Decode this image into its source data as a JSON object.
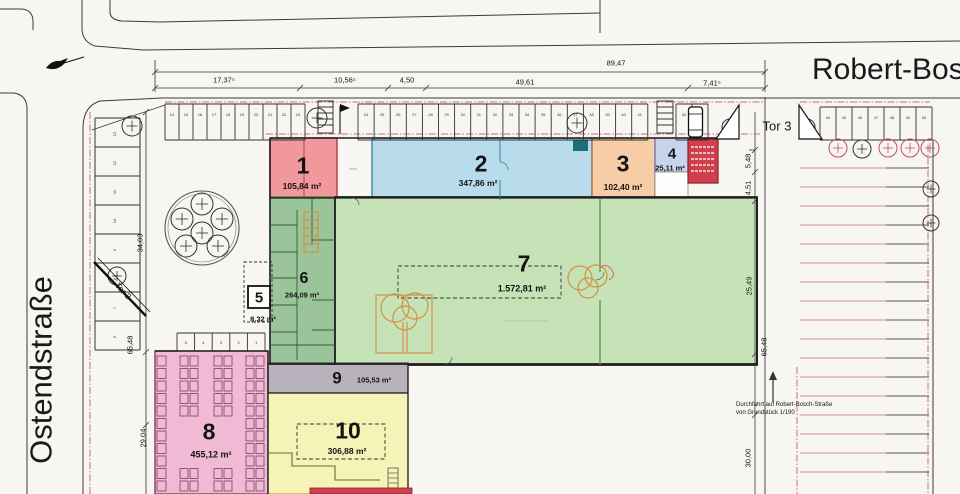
{
  "streets": {
    "top": "Robert-Bosch-Straße",
    "left": "Ostendstraße"
  },
  "gates": {
    "tor3": "Tor 3",
    "tor2": "Tor 2"
  },
  "areas": [
    {
      "num": "1",
      "size": "105,84 m²"
    },
    {
      "num": "2",
      "size": "347,86 m²"
    },
    {
      "num": "3",
      "size": "102,40 m²"
    },
    {
      "num": "4",
      "size": "25,11 m²"
    },
    {
      "num": "5",
      "size": "8,32 m²"
    },
    {
      "num": "6",
      "size": "264,09 m²"
    },
    {
      "num": "7",
      "size": "1.572,81 m²"
    },
    {
      "num": "8",
      "size": "455,12 m²"
    },
    {
      "num": "9",
      "size": "105,53 m²"
    },
    {
      "num": "10",
      "size": "306,88 m²"
    }
  ],
  "dimensions": {
    "total_top": "89,47",
    "top": [
      "17,37⁵",
      "10,56⁵",
      "4,50",
      "49,61",
      "7,41⁵"
    ],
    "left": [
      "34,03",
      "65,48",
      "29,04"
    ],
    "right": [
      "5,48",
      "4,51",
      "25,49",
      "65,48",
      "30,00"
    ]
  },
  "note": {
    "line1": "Durchfahrt auf Robert-Bosch-Straße",
    "line2": "von Grundstück 1/190"
  },
  "parking": {
    "top_row": [
      "14",
      "15",
      "16",
      "17",
      "18",
      "19",
      "20",
      "21",
      "22",
      "23",
      "24",
      "25",
      "26",
      "27",
      "28",
      "29",
      "30",
      "31",
      "32",
      "33",
      "34",
      "35",
      "36",
      "37",
      "38",
      "39",
      "40",
      "41",
      "42",
      "43"
    ],
    "right_row": [
      "44",
      "45",
      "46",
      "47",
      "48",
      "49",
      "50"
    ],
    "left_col": [
      "13",
      "12",
      "11",
      "10",
      "9",
      "8",
      "7",
      "6"
    ],
    "bottom_row": [
      "5",
      "4",
      "3",
      "2",
      "1"
    ]
  },
  "colors": {
    "area1": "#f0989b",
    "area2": "#b9dcec",
    "area3": "#f7cda8",
    "area4": "#c9d3ee",
    "area6": "#9cc49b",
    "area7": "#c6e3b8",
    "area8": "#f0bad4",
    "area9": "#b7b2bc",
    "area10": "#f6f3b6",
    "red_block": "#d0404c",
    "boundary_pink": "#d26a78"
  }
}
